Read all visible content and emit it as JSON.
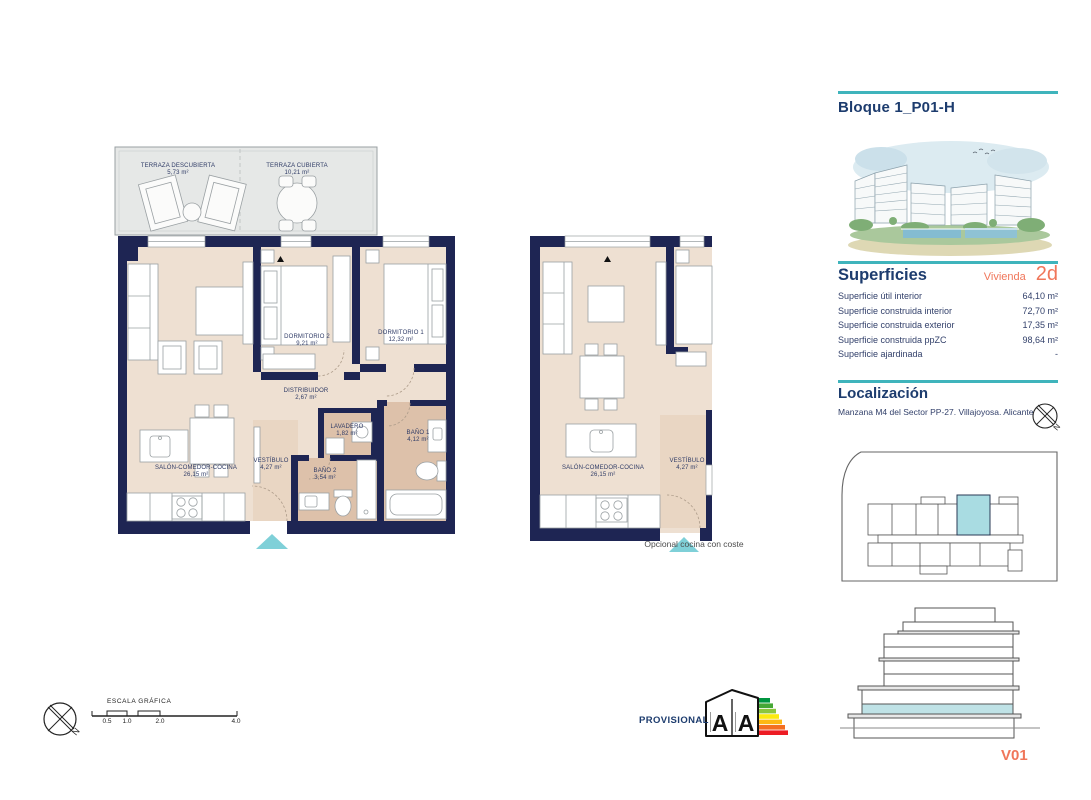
{
  "header": {
    "title": "Bloque 1_P01-H"
  },
  "plans": {
    "main": {
      "terraza_descubierta": {
        "name": "TERRAZA DESCUBIERTA",
        "area": "5,73 m²"
      },
      "terraza_cubierta": {
        "name": "TERRAZA CUBIERTA",
        "area": "10,21 m²"
      },
      "dormitorio2": {
        "name": "DORMITORIO 2",
        "area": "9,21 m²"
      },
      "dormitorio1": {
        "name": "DORMITORIO 1",
        "area": "12,32 m²"
      },
      "distribuidor": {
        "name": "DISTRIBUIDOR",
        "area": "2,67 m²"
      },
      "lavadero": {
        "name": "LAVADERO",
        "area": "1,82 m²"
      },
      "bano1": {
        "name": "BAÑO 1",
        "area": "4,12 m²"
      },
      "bano2": {
        "name": "BAÑO 2",
        "area": "3,54 m²"
      },
      "vestibulo": {
        "name": "VESTÍBULO",
        "area": "4,27 m²"
      },
      "salon": {
        "name": "SALÓN-COMEDOR-COCINA",
        "area": "26,15 m²"
      }
    },
    "variant": {
      "salon": {
        "name": "SALÓN-COMEDOR-COCINA",
        "area": "26,15 m²"
      },
      "vestibulo": {
        "name": "VESTÍBULO",
        "area": "4,27 m²"
      },
      "caption": "Opcional cocina con coste"
    }
  },
  "sidebar": {
    "superficies": {
      "heading": "Superficies",
      "unit_label": "Vivienda",
      "unit_type": "2d",
      "rows": [
        {
          "label": "Superficie útil interior",
          "value": "64,10 m²"
        },
        {
          "label": "Superficie construida interior",
          "value": "72,70 m²"
        },
        {
          "label": "Superficie construida exterior",
          "value": "17,35 m²"
        },
        {
          "label": "Superficie construida ppZC",
          "value": "98,64 m²"
        },
        {
          "label": "Superficie ajardinada",
          "value": "-"
        }
      ]
    },
    "localizacion": {
      "heading": "Localización",
      "address": "Manzana M4 del Sector PP-27. Villajoyosa. Alicante"
    },
    "version": "V01"
  },
  "footer": {
    "scale": {
      "label": "ESCALA GRÁFICA",
      "ticks": [
        "0.5",
        "1.0",
        "2.0",
        "4.0"
      ]
    },
    "provisional": "PROVISIONAL",
    "energy": {
      "letter_left": "A",
      "letter_right": "A"
    }
  },
  "misc": {
    "north_label": "N"
  },
  "colors": {
    "wall": "#1e2553",
    "floor": "#eee0d2",
    "floor_wet": "#ddc1aa",
    "terrace": "#e6e8e7",
    "accent_teal": "#3fb4bc",
    "entrance_teal": "#7fd0d8",
    "unit_highlight": "#a9dce2",
    "coral": "#f0765a",
    "heading_navy": "#1d3c6e"
  }
}
